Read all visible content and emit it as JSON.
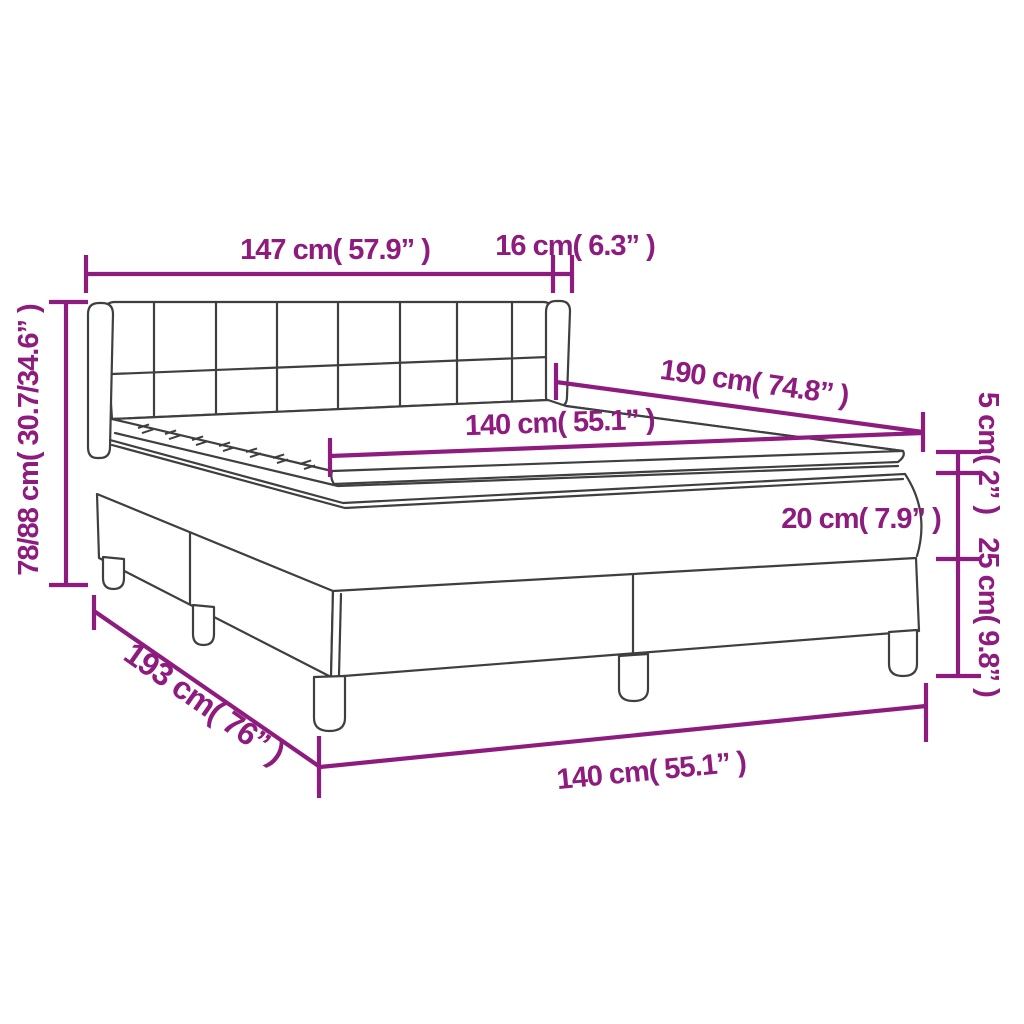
{
  "diagram": {
    "kind": "product-dimension-diagram",
    "subject": "box spring bed with headboard, mattress and topper",
    "accent_color": "#8E1C7E",
    "outline_color": "#3F3F3F",
    "background_color": "#FFFFFF",
    "labels": {
      "headboard_width": "147 cm( 57.9” )",
      "headboard_depth": "16 cm( 6.3” )",
      "mattress_length": "190 cm( 74.8” )",
      "mattress_width": "140 cm( 55.1” )",
      "topper_thickness": "5 cm( 2” )",
      "mattress_thickness": "20 cm( 7.9” )",
      "base_height": "25 cm( 9.8” )",
      "overall_height": "78/88 cm( 30.7/34.6” )",
      "base_length": "193 cm( 76” )",
      "base_width": "140 cm( 55.1” )"
    }
  }
}
